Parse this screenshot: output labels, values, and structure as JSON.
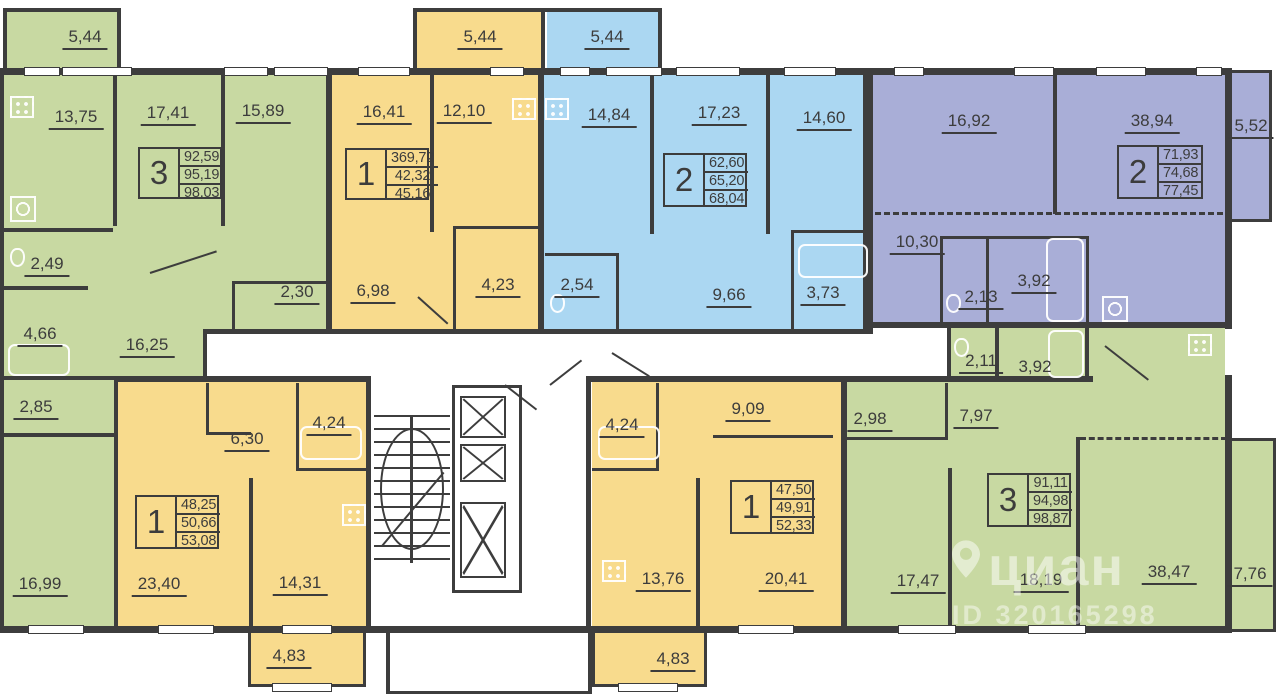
{
  "watermark": {
    "brand": "циан",
    "id_label": "ID 320165298"
  },
  "colors": {
    "apartment_green": "#c8d9a2",
    "apartment_yellow": "#f8db8d",
    "apartment_blue": "#abd7f2",
    "apartment_purple": "#a9aed7",
    "wall": "#3d3d3d"
  },
  "apartments": [
    {
      "name": "3-room apartment (green, top-left)",
      "type": "3",
      "areas": [
        "92,59",
        "95,19",
        "98,03"
      ],
      "rooms": {
        "balcony": "5,44",
        "kitchen": "13,75",
        "room1": "17,41",
        "room2": "15,89",
        "wc": "2,49",
        "bath": "4,66",
        "storage": "2,85",
        "hall": "16,25",
        "niche": "2,30",
        "room3": "16,99"
      }
    },
    {
      "name": "1-room apartment (yellow, top)",
      "type": "1",
      "areas": [
        "369,72",
        "42,32",
        "45,16"
      ],
      "rooms": {
        "balcony": "5,44",
        "living": "16,41",
        "kitchen": "12,10",
        "bath": "4,23",
        "hall": "6,98"
      }
    },
    {
      "name": "2-room apartment (blue, top)",
      "type": "2",
      "areas": [
        "62,60",
        "65,20",
        "68,04"
      ],
      "rooms": {
        "balcony": "5,44",
        "kitchen": "14,84",
        "room1": "17,23",
        "room2": "14,60",
        "wc": "2,54",
        "hall": "9,66",
        "bath": "3,73"
      }
    },
    {
      "name": "2-room apartment (purple, top-right)",
      "type": "2",
      "areas": [
        "71,93",
        "74,68",
        "77,45"
      ],
      "rooms": {
        "room1": "16,92",
        "living_kitchen": "38,94",
        "balcony": "5,52",
        "hall": "10,30",
        "wc": "2,13",
        "bath": "3,92"
      }
    },
    {
      "name": "1-room apartment (yellow, bottom-left)",
      "type": "1",
      "areas": [
        "48,25",
        "50,66",
        "53,08"
      ],
      "rooms": {
        "hall": "6,30",
        "bath": "4,24",
        "living": "23,40",
        "kitchen": "14,31",
        "balcony": "4,83"
      }
    },
    {
      "name": "1-room apartment (yellow, bottom-right)",
      "type": "1",
      "areas": [
        "47,50",
        "49,91",
        "52,33"
      ],
      "rooms": {
        "bath": "4,24",
        "hall": "9,09",
        "kitchen": "13,76",
        "living": "20,41",
        "balcony": "4,83"
      }
    },
    {
      "name": "3-room apartment (green, bottom-right)",
      "type": "3",
      "areas": [
        "91,11",
        "94,98",
        "98,87"
      ],
      "rooms": {
        "storage": "2,98",
        "hall": "7,97",
        "wc": "2,11",
        "bath": "3,92",
        "room1": "17,47",
        "room2": "18,19",
        "living_kitchen": "38,47",
        "balcony": "7,76"
      }
    }
  ]
}
